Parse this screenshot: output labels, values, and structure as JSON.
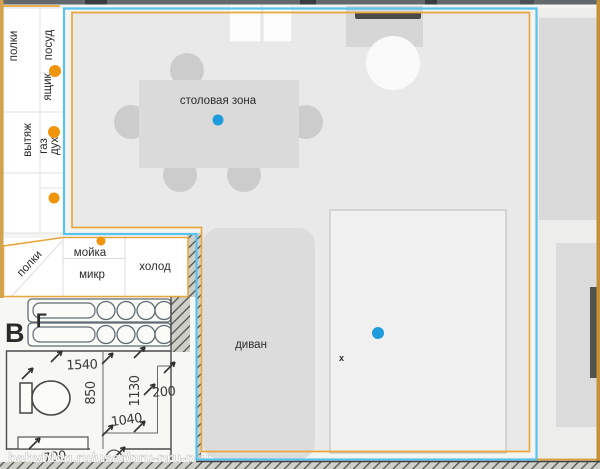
{
  "plan": {
    "cabinets": {
      "shelves_top": "полки",
      "dishes": "посуд",
      "drawer": "ящик",
      "hood": "вытяж",
      "gas": "газ",
      "oven": "дух"
    },
    "counter": {
      "shelves": "полки",
      "sink": "мойка",
      "microwave": "микр",
      "fridge": "холод"
    },
    "living": {
      "dining_zone": "столовая зона",
      "sofa": "диван",
      "x_mark": "x"
    },
    "bathroom": {
      "label_v": "В",
      "label_g": "Г",
      "dim_1540": "1540",
      "dim_850": "850",
      "dim_1130": "1130",
      "dim_200": "200",
      "dim_1040": "1040",
      "dim_700": "700",
      "watermark": "babyblog.ru/user/pru-pru-pru"
    }
  },
  "colors": {
    "marker_orange": "#f0940c",
    "marker_blue": "#1d9cdc",
    "boundary_orange": "#eaa63e",
    "boundary_blue": "#58c4ee",
    "wall_tan": "#d2a24d",
    "wall_dark": "#62686c"
  }
}
